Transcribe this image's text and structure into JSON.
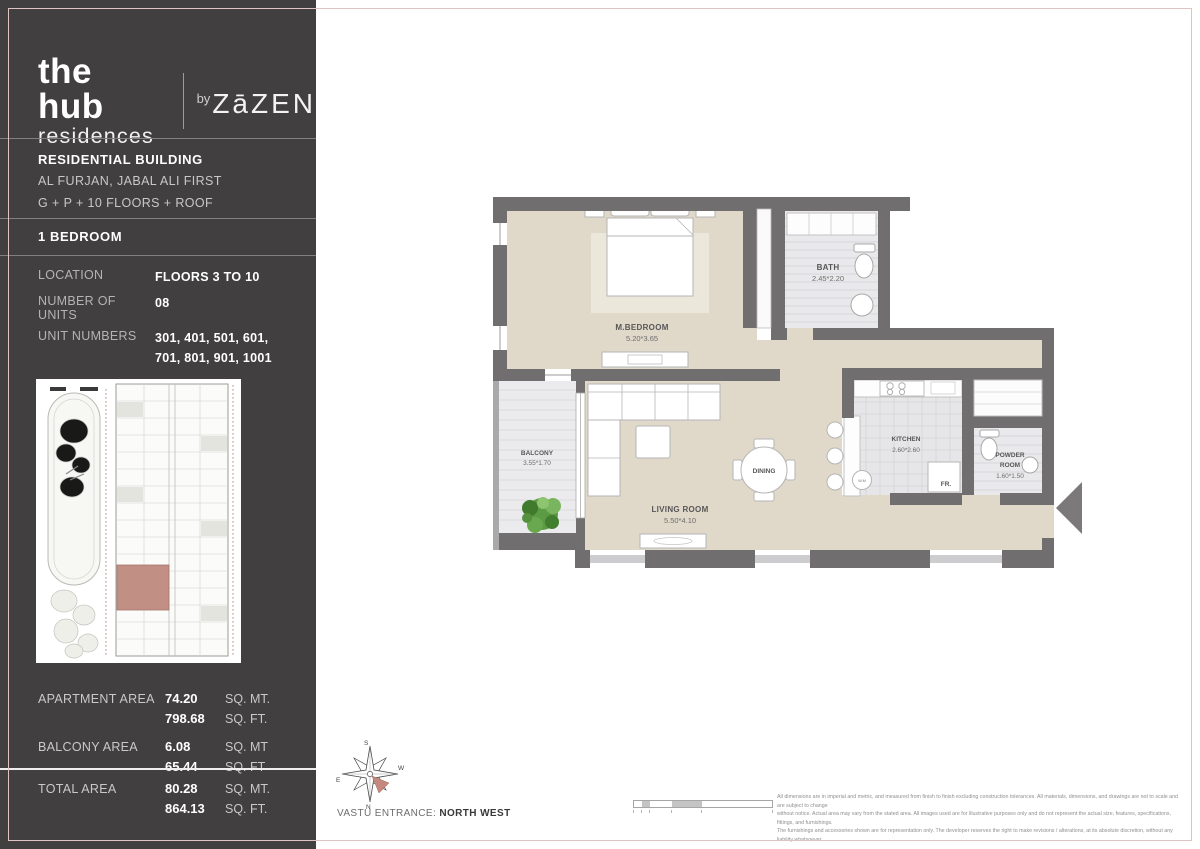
{
  "brand": {
    "line1": "the hub",
    "line2": "residences",
    "by": "by",
    "developer": "ZāZEN"
  },
  "building": {
    "title": "RESIDENTIAL BUILDING",
    "address": "AL FURJAN, JABAL ALI FIRST",
    "floors": "G + P + 10 FLOORS + ROOF",
    "unit_type": "1 BEDROOM"
  },
  "specs": [
    {
      "label": "LOCATION",
      "value": "FLOORS 3 TO 10"
    },
    {
      "label": "NUMBER OF UNITS",
      "value": "08"
    },
    {
      "label": "UNIT NUMBERS",
      "value": "301, 401, 501, 601,",
      "value2": "701, 801, 901, 1001"
    }
  ],
  "areas": {
    "apartment": {
      "label": "APARTMENT AREA",
      "v1": "74.20",
      "u1": "SQ. MT.",
      "v2": "798.68",
      "u2": "SQ. FT."
    },
    "balcony": {
      "label": "BALCONY AREA",
      "v1": "6.08",
      "u1": "SQ. MT",
      "v2": "65.44",
      "u2": "SQ. FT"
    },
    "total": {
      "label": "TOTAL AREA",
      "v1": "80.28",
      "u1": "SQ. MT.",
      "v2": "864.13",
      "u2": "SQ. FT."
    }
  },
  "floorplan": {
    "rooms": {
      "bedroom": {
        "name": "M.BEDROOM",
        "dims": "5.20*3.65"
      },
      "bath": {
        "name": "BATH",
        "dims": "2.45*2.20"
      },
      "balcony": {
        "name": "BALCONY",
        "dims": "3.55*1.70"
      },
      "living": {
        "name": "LIVING ROOM",
        "dims": "5.50*4.10"
      },
      "kitchen": {
        "name": "KITCHEN",
        "dims": "2.60*2.60"
      },
      "powder": {
        "l1": "POWDER",
        "l2": "ROOM",
        "dims": "1.60*1.50"
      },
      "dining": {
        "name": "DINING"
      }
    },
    "labels": {
      "fridge": "FR.",
      "washer": "W.M"
    }
  },
  "compass": {
    "n": "N",
    "s": "S",
    "e": "E",
    "w": "W"
  },
  "footer": {
    "vastu_label": "VASTU ENTRANCE:",
    "vastu_value": "NORTH WEST",
    "disclaimer": [
      "All dimensions are in imperial and metric, and measured from finish to finish excluding construction tolerances. All materials, dimensions, and drawings are not to scale and are subject to change",
      "without notice. Actual area may vary from the stated area. All images used are for illustrative purposes only and do not represent the actual size, features, specifications, fittings, and furnishings.",
      "The furnishings and accessories shown are for representation only. The developer reserves the right to make revisions / alterations, at its absolute discretion, without any liability whatsoever."
    ]
  },
  "colors": {
    "sidebar": "#413f40",
    "accent_pink": "#dfc4c1",
    "highlighted_unit": "#c28f85",
    "wall_gray": "#706e6f",
    "floor_beige": "#e0d9ca"
  }
}
